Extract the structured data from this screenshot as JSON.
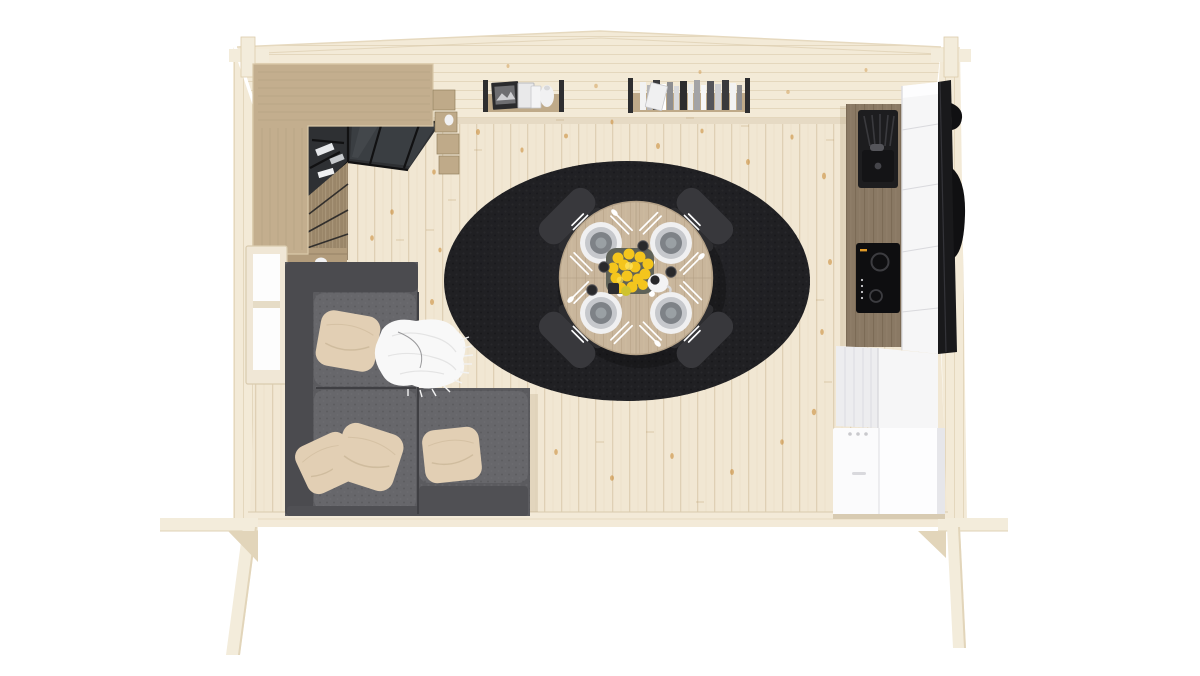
{
  "scene": {
    "title": "Bird's-eye 3D render of an open-plan wooden cabin interior",
    "view": "top-down",
    "rooms": "living room, dining area, kitchen"
  },
  "colors": {
    "background": "#ffffff",
    "floor": "#f1e7d3",
    "floor_edge": "#f3ead8",
    "wall_wood": "#f3ead7",
    "timber": "#f3ecdb",
    "timber_shade": "#e2d5ba",
    "knot": "#c8872f",
    "wardrobe_wood": "#c3ae8e",
    "wardrobe_grain": "#ab9878",
    "cabinet_wood": "#9a8669",
    "cabinet_shelf": "#b29c7c",
    "glass_dark": "#2e3033",
    "glass_frame": "#111112",
    "glass_reflect": "#4a4e52",
    "shelf_wood": "#bfaa89",
    "bracket_dark": "#2e2e30",
    "white_item": "#f1f1f2",
    "rug": "#232326",
    "table_wood": "#c9b69c",
    "table_edge": "#b3a086",
    "chair_back": "#38383c",
    "chair_seat": "#47474b",
    "plate_rim": "#f0f0f1",
    "plate_ring": "#c6c8cc",
    "plate_center": "#7e8287",
    "plate_inner": "#9aa0a4",
    "cutlery": "#ffffff",
    "lemon": "#f4c51d",
    "lemon_green": "#cfc32f",
    "tray": "#5f6258",
    "jug_white": "#f3f3f4",
    "cup_dark": "#29292b",
    "sofa_base": "#5b5b5f",
    "sofa_back": "#4b4b4f",
    "sofa_seat": "#67676b",
    "sofa_front": "#505054",
    "pillow_beige": "#e2cfb4",
    "pillow_shade": "#c8b394",
    "throw_white": "#f8f8f8",
    "throw_shade": "#e0e0e0",
    "window_frame": "#f0e7d6",
    "window_glass": "#fdfdfd",
    "counter_wood": "#8a7964",
    "counter_grain": "#74634e",
    "sink_black": "#1d1d1f",
    "cooktop_black": "#0e0e10",
    "burner_ring": "#3c3c40",
    "cooktop_accent": "#e09a28",
    "cabinet_white": "#f6f6f7",
    "cabinet_white_side": "#ededef",
    "seam_gray": "#d9d9dd",
    "black_unit": "#19191b",
    "appliance_white": "#fbfbfc",
    "shadow_soft": "#d8cbb2"
  },
  "shelves": {
    "book_colors": [
      "#f2f2f2",
      "#b5b5b8",
      "#3a3a3c",
      "#ffffff",
      "#8e8e91",
      "#d9d9db",
      "#2d2d2f",
      "#ececec",
      "#a3a3a6",
      "#f7f7f7",
      "#55555a",
      "#cfcfd2"
    ]
  },
  "objects": {
    "rug": "Black oval rug",
    "dining_table": "Round wooden dining table",
    "dining_chair": "Dark upholstered dining chair",
    "place_setting": "Place setting with plate and cutlery",
    "fruit_tray": "Tray of lemons",
    "jug": "White creamer jug",
    "cup": "Espresso cup",
    "sofa": "L-shaped grey modular sofa",
    "pillow": "Beige cushion",
    "throw": "White fringed throw blanket",
    "wardrobe": "Wooden wardrobe with glass display cabinet",
    "wall_shelf_left": "Wall shelf with framed pictures and vase",
    "wall_shelf_right": "Wall shelf with books",
    "kitchen_counter": "Wooden kitchen counter",
    "sink": "Black sink with drainboard",
    "cooktop": "Black cooktop",
    "tall_cabinet": "White tall kitchen cabinet",
    "black_unit": "Tall black appliance column",
    "appliance": "White appliance box",
    "window": "Window in the left wall",
    "cabin": "Timber cabin shell seen from above"
  }
}
